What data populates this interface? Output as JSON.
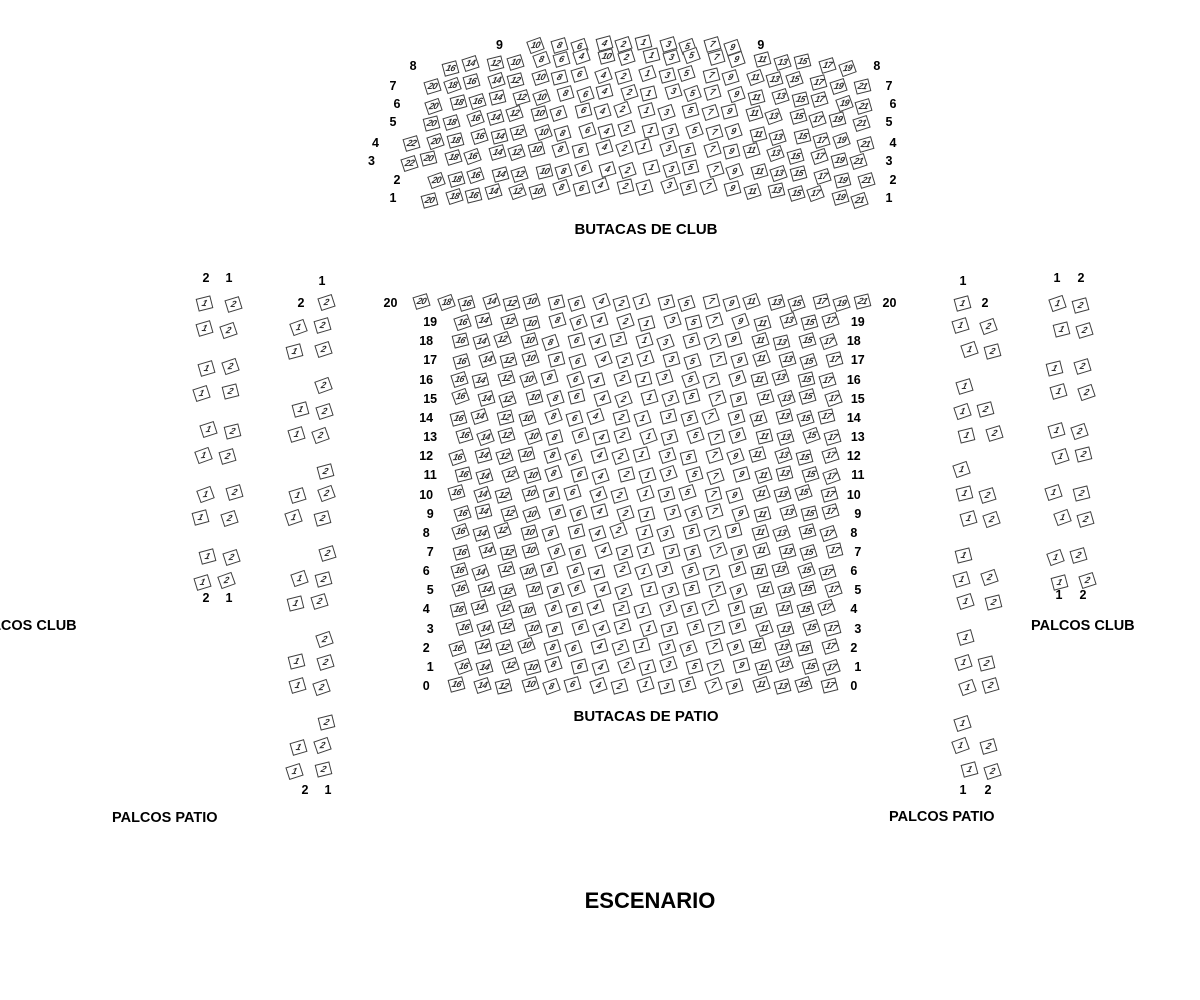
{
  "stage": {
    "label": "ESCENARIO"
  },
  "titles": {
    "club": "BUTACAS DE CLUB",
    "patio": "BUTACAS DE PATIO",
    "palcos_club_left": "PALCOS CLUB",
    "palcos_club_right": "PALCOS CLUB",
    "palcos_patio_left": "PALCOS PATIO",
    "palcos_patio_right": "PALCOS PATIO"
  },
  "colors": {
    "seat_border": "#3f3f3f",
    "seat_fill": "#ffffff",
    "text": "#000000"
  },
  "club": {
    "rows": [
      {
        "label": "9",
        "seats": [
          "10",
          "8",
          "6",
          "4",
          "2",
          "1",
          "3",
          "5",
          "7",
          "9"
        ]
      },
      {
        "label": "8",
        "seats": [
          "16",
          "14",
          "12",
          "10",
          "8",
          "6",
          "4",
          "10",
          "2",
          "1",
          "3",
          "5",
          "7",
          "9",
          "11",
          "13",
          "15",
          "17",
          "19"
        ]
      },
      {
        "label": "7",
        "seats": [
          "20",
          "18",
          "16",
          "14",
          "12",
          "10",
          "8",
          "6",
          "4",
          "2",
          "1",
          "3",
          "5",
          "7",
          "9",
          "11",
          "13",
          "15",
          "17",
          "19",
          "21"
        ]
      },
      {
        "label": "6",
        "seats": [
          "20",
          "18",
          "16",
          "14",
          "12",
          "10",
          "8",
          "6",
          "4",
          "2",
          "1",
          "3",
          "5",
          "7",
          "9",
          "11",
          "13",
          "15",
          "17",
          "19",
          "21"
        ]
      },
      {
        "label": "5",
        "seats": [
          "20",
          "18",
          "16",
          "14",
          "12",
          "10",
          "8",
          "6",
          "4",
          "2",
          "1",
          "3",
          "5",
          "7",
          "9",
          "11",
          "13",
          "15",
          "17",
          "19",
          "21"
        ]
      },
      {
        "label": "4",
        "seats": [
          "22",
          "20",
          "18",
          "16",
          "14",
          "12",
          "10",
          "8",
          "6",
          "4",
          "2",
          "1",
          "3",
          "5",
          "7",
          "9",
          "11",
          "13",
          "15",
          "17",
          "19",
          "21"
        ]
      },
      {
        "label": "3",
        "seats": [
          "22",
          "20",
          "18",
          "16",
          "14",
          "12",
          "10",
          "8",
          "6",
          "4",
          "2",
          "1",
          "3",
          "5",
          "7",
          "9",
          "11",
          "13",
          "15",
          "17",
          "19",
          "21"
        ]
      },
      {
        "label": "2",
        "seats": [
          "20",
          "18",
          "16",
          "14",
          "12",
          "10",
          "8",
          "6",
          "4",
          "2",
          "1",
          "3",
          "5",
          "7",
          "9",
          "11",
          "13",
          "15",
          "17",
          "19",
          "21"
        ]
      },
      {
        "label": "1",
        "seats": [
          "20",
          "18",
          "16",
          "14",
          "12",
          "10",
          "8",
          "6",
          "4",
          "2",
          "1",
          "3",
          "5",
          "7",
          "9",
          "11",
          "13",
          "15",
          "17",
          "19",
          "21"
        ]
      }
    ]
  },
  "patio": {
    "rows": [
      {
        "label": "20",
        "seats": [
          "20",
          "18",
          "16",
          "14",
          "12",
          "10",
          "8",
          "6",
          "4",
          "2",
          "1",
          "3",
          "5",
          "7",
          "9",
          "11",
          "13",
          "15",
          "17",
          "19",
          "21"
        ]
      },
      {
        "label": "19",
        "seats": [
          "16",
          "14",
          "12",
          "10",
          "8",
          "6",
          "4",
          "2",
          "1",
          "3",
          "5",
          "7",
          "9",
          "11",
          "13",
          "15",
          "17"
        ]
      },
      {
        "label": "18",
        "seats": [
          "16",
          "14",
          "12",
          "10",
          "8",
          "6",
          "4",
          "2",
          "1",
          "3",
          "5",
          "7",
          "9",
          "11",
          "13",
          "15",
          "17"
        ]
      },
      {
        "label": "17",
        "seats": [
          "16",
          "14",
          "12",
          "10",
          "8",
          "6",
          "4",
          "2",
          "1",
          "3",
          "5",
          "7",
          "9",
          "11",
          "13",
          "15",
          "17"
        ]
      },
      {
        "label": "16",
        "seats": [
          "16",
          "14",
          "12",
          "10",
          "8",
          "6",
          "4",
          "2",
          "1",
          "3",
          "5",
          "7",
          "9",
          "11",
          "13",
          "15",
          "17"
        ]
      },
      {
        "label": "15",
        "seats": [
          "16",
          "14",
          "12",
          "10",
          "8",
          "6",
          "4",
          "2",
          "1",
          "3",
          "5",
          "7",
          "9",
          "11",
          "13",
          "15",
          "17"
        ]
      },
      {
        "label": "14",
        "seats": [
          "16",
          "14",
          "12",
          "10",
          "8",
          "6",
          "4",
          "2",
          "1",
          "3",
          "5",
          "7",
          "9",
          "11",
          "13",
          "15",
          "17"
        ]
      },
      {
        "label": "13",
        "seats": [
          "16",
          "14",
          "12",
          "10",
          "8",
          "6",
          "4",
          "2",
          "1",
          "3",
          "5",
          "7",
          "9",
          "11",
          "13",
          "15",
          "17"
        ]
      },
      {
        "label": "12",
        "seats": [
          "16",
          "14",
          "12",
          "10",
          "8",
          "6",
          "4",
          "2",
          "1",
          "3",
          "5",
          "7",
          "9",
          "11",
          "13",
          "15",
          "17"
        ]
      },
      {
        "label": "11",
        "seats": [
          "16",
          "14",
          "12",
          "10",
          "8",
          "6",
          "4",
          "2",
          "1",
          "3",
          "5",
          "7",
          "9",
          "11",
          "13",
          "15",
          "17"
        ]
      },
      {
        "label": "10",
        "seats": [
          "16",
          "14",
          "12",
          "10",
          "8",
          "6",
          "4",
          "2",
          "1",
          "3",
          "5",
          "7",
          "9",
          "11",
          "13",
          "15",
          "17"
        ]
      },
      {
        "label": "9",
        "seats": [
          "16",
          "14",
          "12",
          "10",
          "8",
          "6",
          "4",
          "2",
          "1",
          "3",
          "5",
          "7",
          "9",
          "11",
          "13",
          "15",
          "17"
        ]
      },
      {
        "label": "8",
        "seats": [
          "16",
          "14",
          "12",
          "10",
          "8",
          "6",
          "4",
          "2",
          "1",
          "3",
          "5",
          "7",
          "9",
          "11",
          "13",
          "15",
          "17"
        ]
      },
      {
        "label": "7",
        "seats": [
          "16",
          "14",
          "12",
          "10",
          "8",
          "6",
          "4",
          "2",
          "1",
          "3",
          "5",
          "7",
          "9",
          "11",
          "13",
          "15",
          "17"
        ]
      },
      {
        "label": "6",
        "seats": [
          "16",
          "14",
          "12",
          "10",
          "8",
          "6",
          "4",
          "2",
          "1",
          "3",
          "5",
          "7",
          "9",
          "11",
          "13",
          "15",
          "17"
        ]
      },
      {
        "label": "5",
        "seats": [
          "16",
          "14",
          "12",
          "10",
          "8",
          "6",
          "4",
          "2",
          "1",
          "3",
          "5",
          "7",
          "9",
          "11",
          "13",
          "15",
          "17"
        ]
      },
      {
        "label": "4",
        "seats": [
          "16",
          "14",
          "12",
          "10",
          "8",
          "6",
          "4",
          "2",
          "1",
          "3",
          "5",
          "7",
          "9",
          "11",
          "13",
          "15",
          "17"
        ]
      },
      {
        "label": "3",
        "seats": [
          "16",
          "14",
          "12",
          "10",
          "8",
          "6",
          "4",
          "2",
          "1",
          "3",
          "5",
          "7",
          "9",
          "11",
          "13",
          "15",
          "17"
        ]
      },
      {
        "label": "2",
        "seats": [
          "16",
          "14",
          "12",
          "10",
          "8",
          "6",
          "4",
          "2",
          "1",
          "3",
          "5",
          "7",
          "9",
          "11",
          "13",
          "15",
          "17"
        ]
      },
      {
        "label": "1",
        "seats": [
          "16",
          "14",
          "12",
          "10",
          "8",
          "6",
          "4",
          "2",
          "1",
          "3",
          "5",
          "7",
          "9",
          "11",
          "13",
          "15",
          "17"
        ]
      },
      {
        "label": "0",
        "seats": [
          "16",
          "14",
          "12",
          "10",
          "8",
          "6",
          "4",
          "2",
          "1",
          "3",
          "5",
          "7",
          "9",
          "11",
          "13",
          "15",
          "17"
        ]
      }
    ]
  },
  "palcos": {
    "left_outer": {
      "header": [
        "2",
        "1"
      ],
      "footer": [
        "2",
        "1"
      ],
      "groups": [
        [
          [
            "1",
            "2"
          ],
          [
            "1",
            "2"
          ]
        ],
        [
          [
            "1",
            "2"
          ],
          [
            "1",
            "2"
          ]
        ],
        [
          [
            "1",
            "2"
          ],
          [
            "1",
            "2"
          ]
        ],
        [
          [
            "1",
            "2"
          ],
          [
            "1",
            "2"
          ]
        ],
        [
          [
            "1",
            "2"
          ],
          [
            "1",
            "2"
          ]
        ]
      ]
    },
    "left_inner": {
      "header": [
        "1",
        "2"
      ],
      "footer": [
        "2",
        "1"
      ],
      "groups": [
        [
          [
            "2"
          ],
          [
            "1",
            "2"
          ],
          [
            "1",
            "2"
          ]
        ],
        [
          [
            "2"
          ],
          [
            "1",
            "2"
          ],
          [
            "1",
            "2"
          ]
        ],
        [
          [
            "2"
          ],
          [
            "1",
            "2"
          ],
          [
            "1",
            "2"
          ]
        ],
        [
          [
            "2"
          ],
          [
            "1",
            "2"
          ],
          [
            "1",
            "2"
          ]
        ],
        [
          [
            "2"
          ],
          [
            "1",
            "2"
          ],
          [
            "1",
            "2"
          ]
        ],
        [
          [
            "2"
          ],
          [
            "1",
            "2"
          ],
          [
            "1",
            "2"
          ]
        ]
      ]
    },
    "right_inner": {
      "header": [
        "1",
        "2"
      ],
      "footer": [
        "1",
        "2"
      ],
      "groups": [
        [
          [
            "1"
          ],
          [
            "1",
            "2"
          ],
          [
            "1",
            "2"
          ]
        ],
        [
          [
            "1"
          ],
          [
            "1",
            "2"
          ],
          [
            "1",
            "2"
          ]
        ],
        [
          [
            "1"
          ],
          [
            "1",
            "2"
          ],
          [
            "1",
            "2"
          ]
        ],
        [
          [
            "1"
          ],
          [
            "1",
            "2"
          ],
          [
            "1",
            "2"
          ]
        ],
        [
          [
            "1"
          ],
          [
            "1",
            "2"
          ],
          [
            "1",
            "2"
          ]
        ],
        [
          [
            "1"
          ],
          [
            "1",
            "2"
          ],
          [
            "1",
            "2"
          ]
        ]
      ]
    },
    "right_outer": {
      "header": [
        "1",
        "2"
      ],
      "footer": [
        "1",
        "2"
      ],
      "groups": [
        [
          [
            "1",
            "2"
          ],
          [
            "1",
            "2"
          ]
        ],
        [
          [
            "1",
            "2"
          ],
          [
            "1",
            "2"
          ]
        ],
        [
          [
            "1",
            "2"
          ],
          [
            "1",
            "2"
          ]
        ],
        [
          [
            "1",
            "2"
          ],
          [
            "1",
            "2"
          ]
        ],
        [
          [
            "1",
            "2"
          ],
          [
            "1",
            "2"
          ]
        ]
      ]
    }
  }
}
